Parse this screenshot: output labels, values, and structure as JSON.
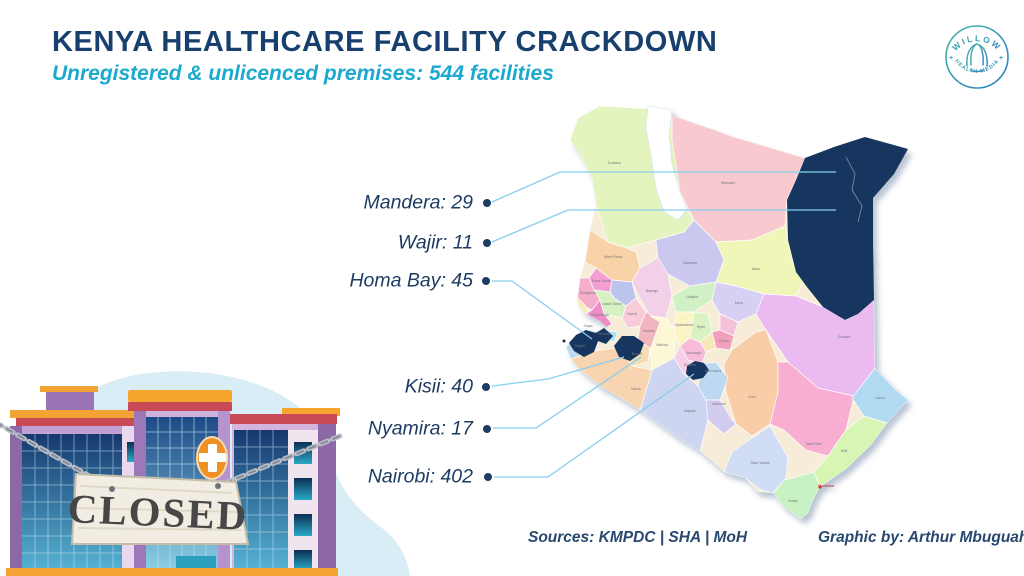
{
  "header": {
    "title": "KENYA HEALTHCARE FACILITY CRACKDOWN",
    "subtitle": "Unregistered & unlicenced premises: 544 facilities"
  },
  "logo": {
    "top_text": "WILLOW",
    "bottom_text": "HEALTH MEDIA"
  },
  "callouts": [
    {
      "county": "Mandera",
      "count": 29,
      "label": "Mandera: 29"
    },
    {
      "county": "Wajir",
      "count": 11,
      "label": "Wajir: 11"
    },
    {
      "county": "Homa Bay",
      "count": 45,
      "label": "Homa Bay: 45"
    },
    {
      "county": "Kisii",
      "count": 40,
      "label": "Kisii: 40"
    },
    {
      "county": "Nyamira",
      "count": 17,
      "label": "Nyamira: 17"
    },
    {
      "county": "Nairobi",
      "count": 402,
      "label": "Nairobi: 402"
    }
  ],
  "map": {
    "county_labels": [
      "Turkana",
      "Marsabit",
      "West Pokot",
      "Trans Nzoia",
      "Bungoma",
      "Uasin Gishu",
      "Baringo",
      "Samburu",
      "Isiolo",
      "Meru",
      "Laikipia",
      "Nandi",
      "Kakamega",
      "Siaya",
      "Kisumu",
      "Kericho",
      "Bomet",
      "Nakuru",
      "Nyandarua",
      "Nyeri",
      "Embu",
      "Murang'a",
      "Kiambu",
      "Narok",
      "Kajiado",
      "Machakos",
      "Makueni",
      "Kitui",
      "Garissa",
      "Tana River",
      "Lamu",
      "Kilifi",
      "Kwale",
      "Taita Taveta",
      "Migori",
      "Mombasa"
    ]
  },
  "illustration": {
    "sign_text": "CLOSED"
  },
  "footer": {
    "sources": "Sources: KMPDC | SHA | MoH",
    "credit": "Graphic by: Arthur Mbuguah"
  },
  "colors": {
    "title_navy": "#17406e",
    "subtitle_teal": "#1ca9cf",
    "highlight_navy": "#17365f",
    "leader_blue": "#85cfee",
    "label_navy": "#1d3c63"
  },
  "chart_data": {
    "type": "map",
    "region": "Kenya counties (choropleth callouts)",
    "title": "Unregistered & unlicenced premises: 544 facilities",
    "unit": "facilities",
    "total": 544,
    "series": [
      {
        "county": "Mandera",
        "value": 29
      },
      {
        "county": "Wajir",
        "value": 11
      },
      {
        "county": "Homa Bay",
        "value": 45
      },
      {
        "county": "Kisii",
        "value": 40
      },
      {
        "county": "Nyamira",
        "value": 17
      },
      {
        "county": "Nairobi",
        "value": 402
      }
    ],
    "highlight_color": "#17365f"
  }
}
